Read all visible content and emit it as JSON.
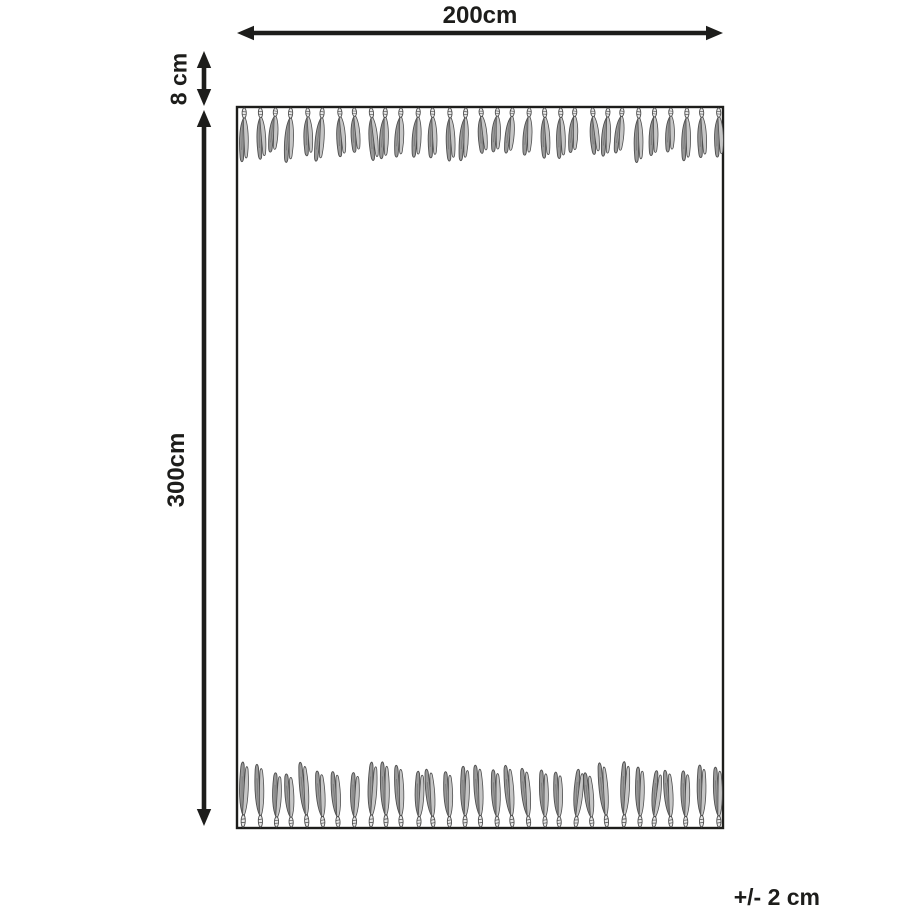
{
  "diagram": {
    "width_label": "200cm",
    "fringe_height_label": "8 cm",
    "height_label": "300cm",
    "tolerance_label": "+/- 2 cm",
    "fringe": {
      "top_tassel_count": 31,
      "bottom_tassel_count": 31
    },
    "colors": {
      "line": "#1d1d1b",
      "background": "#ffffff",
      "rug_fill": "#ffffff",
      "tassel_light": "#c6c6c6",
      "tassel_mid": "#999999",
      "tassel_dark": "#4f4f4f",
      "knot_fill": "#e8e8e8"
    }
  }
}
